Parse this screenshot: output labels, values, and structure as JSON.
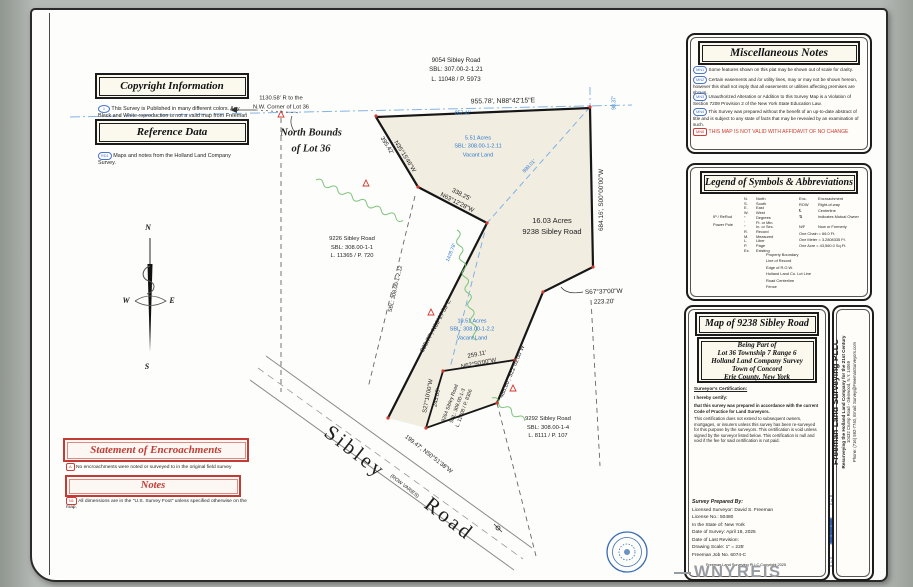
{
  "page": {
    "watermark": "WNYREIS"
  },
  "boxes": {
    "copyright": {
      "title": "Copyright Information",
      "ref": "1",
      "note": "This Survey is Published in many different colors.  Any Black and White reproduction is not a valid map from Freeman Land Surveying PLLC"
    },
    "reference": {
      "title": "Reference Data",
      "ref": "RD1",
      "note": "Maps and notes from the Holland Land Company Survey."
    },
    "encroachments": {
      "title": "Statement of Encroachments",
      "ref": "A",
      "note": "No encroachments were noted or surveyed to in the original field survey"
    },
    "notes": {
      "title": "Notes",
      "ref": "N1",
      "note": "All dimensions are in the \"U.S. Survey Foot\" unless specified otherwise on the map."
    },
    "misc": {
      "title": "Miscellaneous Notes",
      "items": [
        {
          "ref": "MN1",
          "text": "Some features shown on this plat may be shown out of scale for clarity."
        },
        {
          "ref": "MN2",
          "text": "Certain easements and /or utility lines, may or may not be shown hereon, however this shall not imply that all easements or utilities affecting premises are shown."
        },
        {
          "ref": "MN3",
          "text": "Unauthorized Alteration or Addition to this Survey Map is a Violation of Section 7209 Provision 2 of the New York State Education Law."
        },
        {
          "ref": "MN4",
          "text": "This Survey was prepared without the benefit of an up-to-date abstract of title and is subject to any state of facts that may be revealed by an examination of such."
        },
        {
          "ref": "MN5",
          "text": "THIS MAP IS NOT VALID WITH AFFIDAVIT OF NO CHANGE"
        }
      ]
    },
    "legend": {
      "title": "Legend of Symbols & Abbreviations",
      "symbols": [
        {
          "label": "IP / ReRod"
        },
        {
          "label": "Power Pole"
        }
      ],
      "abbr1": [
        [
          "N.",
          "North"
        ],
        [
          "S.",
          "South"
        ],
        [
          "E.",
          "East"
        ],
        [
          "W.",
          "West"
        ],
        [
          "°",
          "Degrees"
        ],
        [
          "'",
          "Ft. or Min."
        ],
        [
          "\"",
          "In. or Sec."
        ],
        [
          "R.",
          "Record"
        ],
        [
          "M.",
          "Measured"
        ],
        [
          "L.",
          "Liber"
        ],
        [
          "P.",
          "Page"
        ],
        [
          "Ex.",
          "Existing"
        ]
      ],
      "abbr2": [
        [
          "Enc.",
          "Encroachment"
        ],
        [
          "ROW",
          "Right-of-way"
        ],
        [
          "℄",
          "Centerline"
        ],
        [
          "⇅",
          "Indicates Mutual Owner"
        ],
        [
          "N/F",
          "Now or Formerly"
        ],
        [
          "",
          "One Chain = 66.0 Ft."
        ],
        [
          "",
          "One Meter = 3.2808335 Ft."
        ],
        [
          "",
          "One Acre = 43,560.0 Sq.Ft."
        ]
      ],
      "lines": [
        "Property Boundary",
        "Line of Record",
        "Edge of R.O.W.",
        "Holland Land Co. Lot Line",
        "Road Centerline",
        "Fence"
      ]
    },
    "title_block": {
      "title": "Map of 9238 Sibley Road",
      "being": [
        "Being Part of",
        "Lot 36 Township 7 Range 6",
        "Holland Land Company Survey",
        "Town of Concord",
        "Erie County, New York"
      ],
      "cert_heading": "Surveyor's Certification:",
      "cert_intro": "I hereby certify:",
      "cert_p1": "that this survey was prepared in accordance with the current  Code of Practice for Land Surveyors.",
      "cert_p2": "This certification does not extend to subsequent owners, mortgages, or insurers unless this survey has been re-surveyed for this purpose by the surveyors.  This certification is void unless signed by the surveyor listed below. This certification is null and void if the fee for said certification is not paid.",
      "prepared_heading": "Survey Prepared By:",
      "prepared": [
        "Licensed Surveyor: David S. Freeman",
        "License No.: 50480",
        "In the State of: New York",
        "Date of Survey: April 18, 2025",
        "Date of Last Revision:",
        "Drawing Scale: 1\" = 225'",
        "Freeman Job No. 6074-C"
      ],
      "copyright": "Freeman Land Surveying PLLC Copyright 2025"
    },
    "banner": {
      "company": "Freeman Land Surveying PLLC",
      "tagline": "Resurveying the Holland Land Company for the 21st Century",
      "address": "10432 Crump Road - Glenwood, N.Y. 14069",
      "contact": "Phone: (716) 592-7740, Email: Survey@FreemanSurveyors.com",
      "seal_text": "FREEMAN LAND SURVEYING PLLC • 592 - 7740 •"
    }
  },
  "map": {
    "compass": {
      "n": "N",
      "s": "S",
      "e": "E",
      "w": "W"
    },
    "north_bounds": [
      "North Bounds",
      "of Lot 36"
    ],
    "nw_ref": [
      "1130.58' R to the",
      "N.W. Corner of Lot 36"
    ],
    "road": {
      "name_top": "Sibley",
      "name_bottom": "Road",
      "row": "(ROW VARIES)"
    },
    "parcels": {
      "p9054": [
        "9054 Sibley Road",
        "SBL: 307.00-2-1.21",
        "L. 11048 / P. 5973"
      ],
      "p9226": [
        "9226 Sibley Road",
        "SBL: 308.00-1-1",
        "L. 11365 / P. 720"
      ],
      "p9238": [
        "16.03 Acres",
        "9238 Sibley Road"
      ],
      "v551": [
        "5.51 Acres",
        "SBL: 308.00-1-2.11",
        "Vacant Land"
      ],
      "v1051": [
        "10.51 Acres",
        "SBL: 308.00-1-2.2",
        "Vacant Land"
      ],
      "p9264": [
        "9264 Sibley Road",
        "SBL: 308.00-1-3",
        "L. 11308 / P. 8306"
      ],
      "p9292": [
        "9292 Sibley Road",
        "SBL: 308.00-1-4",
        "L. 8111 / P. 107"
      ],
      "strip_sbl": "SBL: 308.00-1-2.12"
    },
    "dims": {
      "top": "955.78', N88°42'15\"E",
      "top_inner": "857.41'",
      "east": "684.16', S00°00'00\"W",
      "east_small": "98.37'",
      "rec1": "899.01'",
      "rec2": "1428.78'",
      "nw1": "395.42'",
      "nw1b": "N35°15'46\"W",
      "nw2": "338.25'",
      "nw2b": "N63°12'28\"W",
      "west": "835.77', N33°27'59\"E",
      "s1a": "S67°37'00\"W",
      "s1b": "223.20'",
      "s2": "486.80', S22°02'00\"W",
      "s3a": "259.11'",
      "s3b": "N62°50'00\"W",
      "s4a": "S27°10'00\"W",
      "s4b": "245.05'",
      "s5": "199.47', N50°51'38\"W"
    }
  }
}
